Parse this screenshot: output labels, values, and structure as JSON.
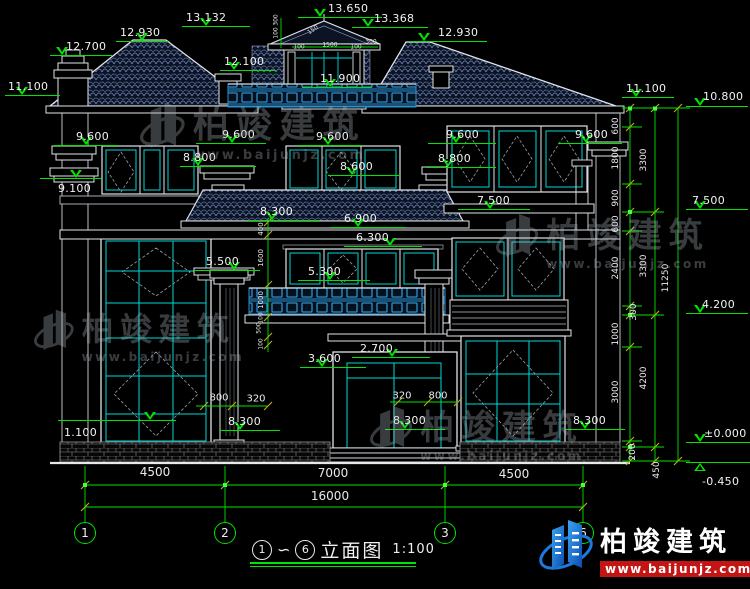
{
  "drawing": {
    "title": {
      "from_bubble": "1",
      "tilde": "∽",
      "to_bubble": "6",
      "name": "立面图",
      "scale": "1:100"
    },
    "brand": {
      "name": "柏竣建筑",
      "url": "www.baijunjz.com"
    },
    "colors": {
      "dim_green": "#00e400",
      "text_white": "#f0f0f0",
      "window_cyan": "#00d8d8",
      "lattice_blue": "#2e8fd0",
      "tick_yellow": "#b7a81c",
      "logo_red": "#c41414",
      "logo_blue": "#2a8ae0",
      "roof_line": "#6d82b5"
    },
    "grid_bubbles": [
      {
        "label": "1",
        "x": 85
      },
      {
        "label": "2",
        "x": 225
      },
      {
        "label": "3",
        "x": 445
      },
      {
        "label": "6",
        "x": 583
      }
    ],
    "elevation_markers": [
      {
        "value": "12.700",
        "tx": 66,
        "ty": 40,
        "lx": 50,
        "lw": 62,
        "ly": 55,
        "trx": 62
      },
      {
        "value": "12.930",
        "tx": 120,
        "ty": 26,
        "lx": 116,
        "lw": 52,
        "ly": 41,
        "trx": 142
      },
      {
        "value": "13.132",
        "tx": 186,
        "ty": 11,
        "lx": 182,
        "lw": 68,
        "ly": 26,
        "trx": 206
      },
      {
        "value": "13.650",
        "tx": 328,
        "ty": 2,
        "lx": 298,
        "lw": 84,
        "ly": 17,
        "trx": 320
      },
      {
        "value": "13.368",
        "tx": 374,
        "ty": 12,
        "lx": 352,
        "lw": 76,
        "ly": 27,
        "trx": 368
      },
      {
        "value": "12.100",
        "tx": 224,
        "ty": 55,
        "lx": 220,
        "lw": 56,
        "ly": 70,
        "trx": 234
      },
      {
        "value": "11.900",
        "tx": 320,
        "ty": 72,
        "lx": 302,
        "lw": 70,
        "ly": 87,
        "trx": 330
      },
      {
        "value": "12.930",
        "tx": 438,
        "ty": 26,
        "lx": 410,
        "lw": 77,
        "ly": 41,
        "trx": 424
      },
      {
        "value": "11.100",
        "tx": 8,
        "ty": 80,
        "lx": 5,
        "lw": 55,
        "ly": 95,
        "trx": 22
      },
      {
        "value": "11.100",
        "tx": 626,
        "ty": 82,
        "lx": 622,
        "lw": 52,
        "ly": 97,
        "trx": 636
      },
      {
        "value": "10.800",
        "tx": 703,
        "ty": 90,
        "lx": 686,
        "lw": 62,
        "ly": 106,
        "trx": 700
      },
      {
        "value": "9.600",
        "tx": 76,
        "ty": 130,
        "lx": 54,
        "lw": 64,
        "ly": 145,
        "trx": 86
      },
      {
        "value": "9.600",
        "tx": 222,
        "ty": 128,
        "lx": 196,
        "lw": 70,
        "ly": 143,
        "trx": 232
      },
      {
        "value": "9.600",
        "tx": 316,
        "ty": 130,
        "lx": 298,
        "lw": 64,
        "ly": 145,
        "trx": 328
      },
      {
        "value": "9.600",
        "tx": 446,
        "ty": 128,
        "lx": 428,
        "lw": 68,
        "ly": 143,
        "trx": 456
      },
      {
        "value": "9.600",
        "tx": 575,
        "ty": 128,
        "lx": 558,
        "lw": 64,
        "ly": 143,
        "trx": 586
      },
      {
        "value": "9.100",
        "tx": 58,
        "ty": 182,
        "lx": 40,
        "lw": 62,
        "ly": 178,
        "trx": 76
      },
      {
        "value": "8.800",
        "tx": 183,
        "ty": 151,
        "lx": 180,
        "lw": 76,
        "ly": 166,
        "trx": 198
      },
      {
        "value": "8.800",
        "tx": 438,
        "ty": 152,
        "lx": 426,
        "lw": 70,
        "ly": 167,
        "trx": 448
      },
      {
        "value": "8.600",
        "tx": 340,
        "ty": 160,
        "lx": 328,
        "lw": 72,
        "ly": 175,
        "trx": 352
      },
      {
        "value": "8.300",
        "tx": 260,
        "ty": 205,
        "lx": 248,
        "lw": 72,
        "ly": 220,
        "trx": 272
      },
      {
        "value": "6.900",
        "tx": 344,
        "ty": 212,
        "lx": 330,
        "lw": 76,
        "ly": 227,
        "trx": 358
      },
      {
        "value": "6.300",
        "tx": 356,
        "ty": 231,
        "lx": 344,
        "lw": 78,
        "ly": 246,
        "trx": 390
      },
      {
        "value": "5.500",
        "tx": 206,
        "ty": 255,
        "lx": 194,
        "lw": 66,
        "ly": 270,
        "trx": 234
      },
      {
        "value": "5.300",
        "tx": 308,
        "ty": 265,
        "lx": 298,
        "lw": 72,
        "ly": 280,
        "trx": 330
      },
      {
        "value": "7.500",
        "tx": 477,
        "ty": 194,
        "lx": 458,
        "lw": 72,
        "ly": 209,
        "trx": 490
      },
      {
        "value": "7.500",
        "tx": 692,
        "ty": 194,
        "lx": 686,
        "lw": 62,
        "ly": 209,
        "trx": 700
      },
      {
        "value": "4.200",
        "tx": 702,
        "ty": 298,
        "lx": 686,
        "lw": 62,
        "ly": 313,
        "trx": 700
      },
      {
        "value": "3.600",
        "tx": 308,
        "ty": 352,
        "lx": 300,
        "lw": 66,
        "ly": 367,
        "trx": 322
      },
      {
        "value": "2.700",
        "tx": 360,
        "ty": 342,
        "lx": 352,
        "lw": 78,
        "ly": 357,
        "trx": 392
      },
      {
        "value": "1.100",
        "tx": 64,
        "ty": 426,
        "lx": 58,
        "lw": 118,
        "ly": 420,
        "trx": 150
      },
      {
        "value": "8.300",
        "tx": 228,
        "ty": 415,
        "lx": 220,
        "lw": 60,
        "ly": 430,
        "trx": 240
      },
      {
        "value": "8.300",
        "tx": 393,
        "ty": 414,
        "lx": 385,
        "lw": 60,
        "ly": 429,
        "trx": 405
      },
      {
        "value": "8.300",
        "tx": 573,
        "ty": 414,
        "lx": 565,
        "lw": 60,
        "ly": 429,
        "trx": 585
      },
      {
        "value": "±0.000",
        "tx": 704,
        "ty": 427,
        "lx": 686,
        "lw": 64,
        "ly": 442,
        "trx": 700
      },
      {
        "value": "-0.450",
        "tx": 702,
        "ty": 475,
        "lx": 686,
        "lw": 64,
        "ly": 462,
        "trx": 700,
        "flip": true
      }
    ],
    "dimension_labels": [
      {
        "t": "600",
        "x": 616,
        "y": 126,
        "r": 90,
        "s": 9
      },
      {
        "t": "1800",
        "x": 616,
        "y": 158,
        "r": 90,
        "s": 9
      },
      {
        "t": "900",
        "x": 616,
        "y": 198,
        "r": 90,
        "s": 9
      },
      {
        "t": "600",
        "x": 616,
        "y": 224,
        "r": 90,
        "s": 9
      },
      {
        "t": "2400",
        "x": 616,
        "y": 268,
        "r": 90,
        "s": 9
      },
      {
        "t": "300",
        "x": 634,
        "y": 312,
        "r": 90,
        "s": 9
      },
      {
        "t": "1000",
        "x": 616,
        "y": 334,
        "r": 90,
        "s": 9
      },
      {
        "t": "3000",
        "x": 616,
        "y": 392,
        "r": 90,
        "s": 9
      },
      {
        "t": "200",
        "x": 633,
        "y": 452,
        "r": 90,
        "s": 9
      },
      {
        "t": "3300",
        "x": 644,
        "y": 160,
        "r": 90,
        "s": 9
      },
      {
        "t": "3300",
        "x": 644,
        "y": 266,
        "r": 90,
        "s": 9
      },
      {
        "t": "4200",
        "x": 644,
        "y": 378,
        "r": 90,
        "s": 9
      },
      {
        "t": "450",
        "x": 657,
        "y": 470,
        "r": 90,
        "s": 9
      },
      {
        "t": "11250",
        "x": 666,
        "y": 278,
        "r": 90,
        "s": 9
      },
      {
        "t": "400",
        "x": 261,
        "y": 229,
        "r": 90,
        "s": 7
      },
      {
        "t": "1600",
        "x": 261,
        "y": 258,
        "r": 90,
        "s": 7
      },
      {
        "t": "1000",
        "x": 261,
        "y": 300,
        "r": 90,
        "s": 7
      },
      {
        "t": "100",
        "x": 261,
        "y": 318,
        "r": 90,
        "s": 6
      },
      {
        "t": "500",
        "x": 259,
        "y": 328,
        "r": 90,
        "s": 6
      },
      {
        "t": "100",
        "x": 261,
        "y": 344,
        "r": 90,
        "s": 6
      },
      {
        "t": "300",
        "x": 276,
        "y": 20,
        "r": 90,
        "s": 6
      },
      {
        "t": "100",
        "x": 276,
        "y": 33,
        "r": 90,
        "s": 6
      },
      {
        "t": "150",
        "x": 313,
        "y": 30,
        "r": -35,
        "s": 6
      },
      {
        "t": "100",
        "x": 299,
        "y": 47,
        "r": 0,
        "s": 6
      },
      {
        "t": "1500",
        "x": 330,
        "y": 45,
        "r": 0,
        "s": 6
      },
      {
        "t": "100",
        "x": 356,
        "y": 47,
        "r": 0,
        "s": 6
      },
      {
        "t": "300",
        "x": 371,
        "y": 42,
        "r": 0,
        "s": 6
      },
      {
        "t": "800",
        "x": 219,
        "y": 398,
        "r": 0,
        "s": 10
      },
      {
        "t": "320",
        "x": 256,
        "y": 399,
        "r": 0,
        "s": 10
      },
      {
        "t": "320",
        "x": 402,
        "y": 396,
        "r": 0,
        "s": 10
      },
      {
        "t": "800",
        "x": 438,
        "y": 396,
        "r": 0,
        "s": 10
      },
      {
        "t": "4500",
        "x": 155,
        "y": 472,
        "r": 0,
        "s": 12
      },
      {
        "t": "7000",
        "x": 333,
        "y": 473,
        "r": 0,
        "s": 12
      },
      {
        "t": "4500",
        "x": 514,
        "y": 474,
        "r": 0,
        "s": 12
      },
      {
        "t": "16000",
        "x": 330,
        "y": 496,
        "r": 0,
        "s": 12
      }
    ],
    "watermarks": [
      {
        "x": 140,
        "y": 96,
        "cs": 36,
        "us": 13
      },
      {
        "x": 34,
        "y": 304,
        "cs": 32,
        "us": 12
      },
      {
        "x": 496,
        "y": 208,
        "cs": 34,
        "us": 12
      },
      {
        "x": 370,
        "y": 400,
        "cs": 34,
        "us": 12
      }
    ]
  }
}
